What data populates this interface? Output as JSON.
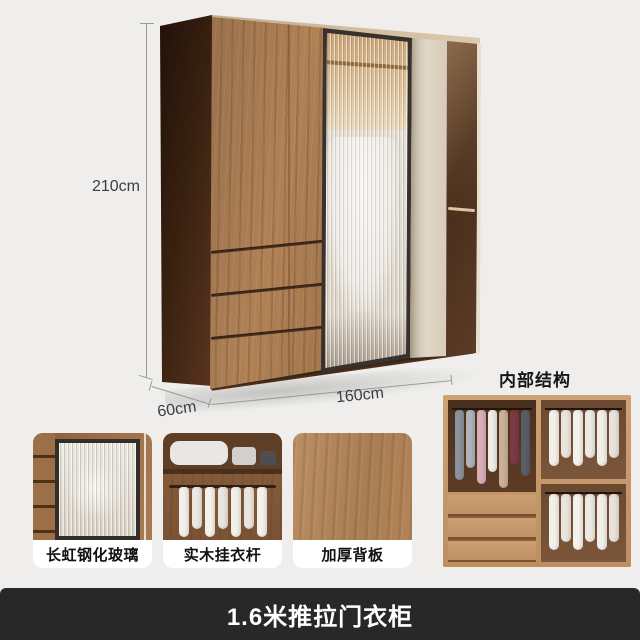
{
  "product": {
    "dimension_height": "210cm",
    "dimension_depth": "60cm",
    "dimension_width": "160cm",
    "interior_title": "内部结构"
  },
  "features": [
    {
      "label": "长虹钢化玻璃"
    },
    {
      "label": "实木挂衣杆"
    },
    {
      "label": "加厚背板"
    }
  ],
  "banner": {
    "title": "1.6米推拉门衣柜"
  },
  "colors": {
    "background": "#efeeec",
    "banner_bg": "#282828",
    "banner_text": "#ffffff",
    "dimension_text": "#3d3d3d",
    "wood_front": "#ab8155",
    "wood_side_dark": "#37200f",
    "glass_frame": "#37322e",
    "cream_door": "#e2d8c8"
  },
  "interior": {
    "left_clothes": [
      "#8b929c",
      "#aeb4bb",
      "#d9aeb8",
      "#f0ece6",
      "#c9b096",
      "#7c3a42",
      "#585e66"
    ],
    "right_top_clothes": [
      "#f3f0ea",
      "#e9e5de",
      "#f5f2ec",
      "#eceae3",
      "#f2efe9",
      "#e7e3db"
    ],
    "right_bottom_clothes": [
      "#f3f0ea",
      "#e9e5de",
      "#f5f2ec",
      "#eceae3",
      "#f2efe9",
      "#e7e3db"
    ],
    "card2_clothes": [
      "#f3f0ea",
      "#ece8e0",
      "#f5f2ec",
      "#e9e5dd",
      "#f2efe9",
      "#eae6de",
      "#f4f1eb"
    ]
  }
}
